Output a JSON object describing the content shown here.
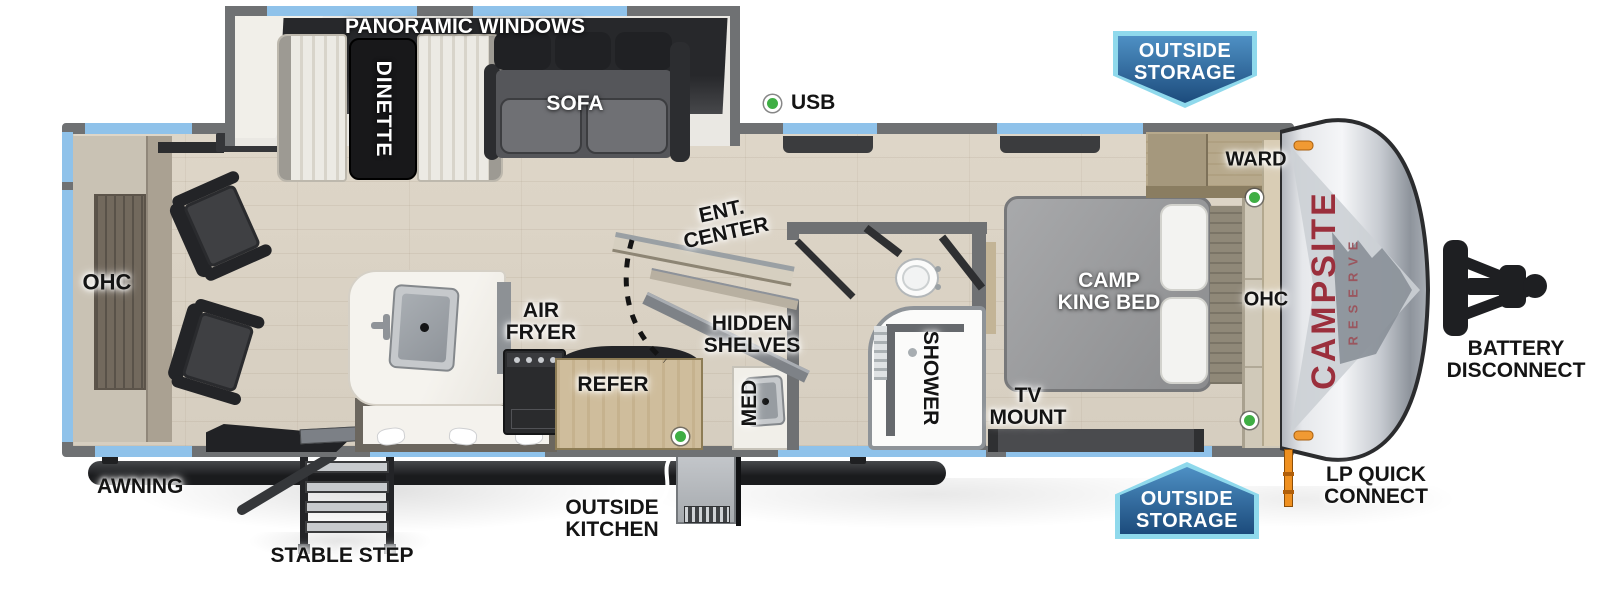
{
  "labels": {
    "panoramic_windows": "PANORAMIC WINDOWS",
    "dinette": "DINETTE",
    "sofa": "SOFA",
    "usb": "USB",
    "ohc_rear": "OHC",
    "ent_center": {
      "l1": "ENT.",
      "l2": "CENTER"
    },
    "hidden_shelves": {
      "l1": "HIDDEN",
      "l2": "SHELVES"
    },
    "air_fryer": {
      "l1": "AIR",
      "l2": "FRYER"
    },
    "refer": "REFER",
    "med": "MED",
    "shower": "SHOWER",
    "camp_king_bed": {
      "l1": "CAMP",
      "l2": "KING BED"
    },
    "ward": "WARD",
    "ohc_bedroom": "OHC",
    "tv_mount": {
      "l1": "TV",
      "l2": "MOUNT"
    },
    "awning": "AWNING",
    "stable_step": "STABLE STEP",
    "outside_kitchen": {
      "l1": "OUTSIDE",
      "l2": "KITCHEN"
    },
    "battery_disconnect": {
      "l1": "BATTERY",
      "l2": "DISCONNECT"
    },
    "lp_quick_connect": {
      "l1": "LP QUICK",
      "l2": "CONNECT"
    },
    "storage_badge_top": {
      "l1": "OUTSIDE",
      "l2": "STORAGE"
    },
    "storage_badge_bottom": {
      "l1": "OUTSIDE",
      "l2": "STORAGE"
    }
  },
  "brand": {
    "name": "CAMPSITE",
    "series": "RESERVE"
  },
  "colors": {
    "wall_gray": "#6f7173",
    "window_blue": "#8fc2ea",
    "marker_green": "#3fae44",
    "badge_border": "#8fd9ec",
    "badge_blue_light": "#4e90c4",
    "badge_blue_dark": "#1c4b7c",
    "brand_red": "#9b2f3c",
    "label_black": "#141414",
    "awning_black": "#1a1b1d"
  }
}
